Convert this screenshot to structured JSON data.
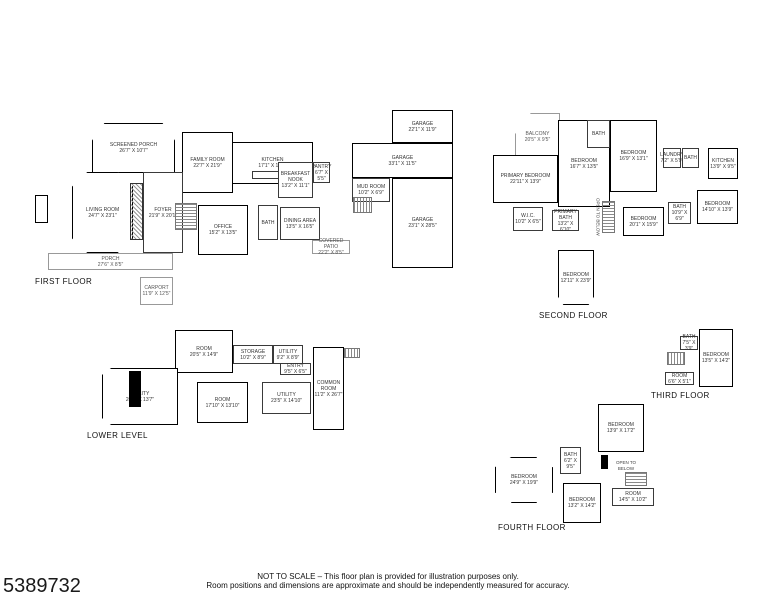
{
  "floors": {
    "first": {
      "name": "FIRST FLOOR",
      "rooms": {
        "screened_porch": "SCREENED PORCH\n26'7\" X 10'7\"",
        "family_room": "FAMILY ROOM\n22'7\" X 21'9\"",
        "kitchen": "KITCHEN\n17'1\" X 15'5\"",
        "breakfast_nook": "BREAKFAST NOOK\n13'2\" X 11'1\"",
        "pantry": "PANTRY\n6'7\" X 5'5\"",
        "living_room": "LIVING ROOM\n24'7\" X 23'1\"",
        "foyer": "FOYER\n21'9\" X 20'1\"",
        "office": "OFFICE\n15'2\" X 13'5\"",
        "bath": "BATH",
        "dining_area": "DINING AREA\n13'5\" X 16'5\"",
        "covered_patio": "COVERED PATIO\n22'2\" X 8'5\"",
        "porch": "PORCH\n27'6\" X 8'5\"",
        "carport": "CARPORT\n11'9\" X 12'5\"",
        "mud_room": "MUD ROOM\n10'2\" X 6'9\"",
        "garage_1": "GARAGE\n22'1\" X 11'9\"",
        "garage_2": "GARAGE\n33'1\" X 11'5\"",
        "garage_3": "GARAGE\n23'1\" X 28'5\""
      }
    },
    "second": {
      "name": "SECOND FLOOR",
      "rooms": {
        "balcony": "BALCONY\n20'5\" X 9'5\"",
        "bedroom_1": "BEDROOM\n16'7\" X 13'5\"",
        "bath_1": "BATH",
        "bedroom_2": "BEDROOM\n16'9\" X 13'1\"",
        "primary_bedroom": "PRIMARY BEDROOM\n22'11\" X 13'9\"",
        "laundry": "LAUNDRY\n7'2\" X 5'9\"",
        "bath_2": "BATH",
        "kitchen": "KITCHEN\n13'9\" X 9'5\"",
        "bedroom_3": "BEDROOM\n14'10\" X 13'9\"",
        "bath_3": "BATH\n10'9\" X 6'9\"",
        "wic": "W.I.C.\n10'2\" X 6'5\"",
        "primary_bath": "PRIMARY BATH\n13'2\" X 6'10\"",
        "bedroom_4": "BEDROOM\n20'1\" X 15'9\"",
        "open_to_below": "OPEN TO BELOW",
        "bedroom_5": "BEDROOM\n12'11\" X 23'9\""
      }
    },
    "third": {
      "name": "THIRD FLOOR",
      "rooms": {
        "bath": "BATH\n7'5\" X 3'9\"",
        "bedroom": "BEDROOM\n13'5\" X 14'2\"",
        "room": "ROOM\n6'6\" X 5'1\""
      }
    },
    "fourth": {
      "name": "FOURTH FLOOR",
      "rooms": {
        "bedroom_1": "BEDROOM\n13'9\" X 17'2\"",
        "bath": "BATH\n6'2\" X 9'5\"",
        "bedroom_2": "BEDROOM\n24'9\" X 19'9\"",
        "bedroom_3": "BEDROOM\n13'2\" X 14'2\"",
        "open_to_below": "OPEN TO BELOW",
        "room": "ROOM\n14'5\" X 10'2\""
      }
    },
    "lower": {
      "name": "LOWER LEVEL",
      "rooms": {
        "room_1": "ROOM\n20'5\" X 14'9\"",
        "storage": "STORAGE\n10'2\" X 8'9\"",
        "utility_1": "UTILITY\n9'2\" X 8'9\"",
        "entry": "ENTRY\n9'5\" X 6'5\"",
        "utility_2": "UTILITY\n20'7\" X 13'7\"",
        "room_2": "ROOM\n17'10\" X 13'10\"",
        "utility_3": "UTILITY\n23'5\" X 14'10\"",
        "common_room": "COMMON ROOM\n11'2\" X 26'7\""
      }
    }
  },
  "footer": {
    "listing_number": "5389732",
    "disclaimer_line1": "NOT TO SCALE – This floor plan is provided for illustration purposes only.",
    "disclaimer_line2": "Room positions and dimensions are approximate and should be independently measured for accuracy."
  }
}
